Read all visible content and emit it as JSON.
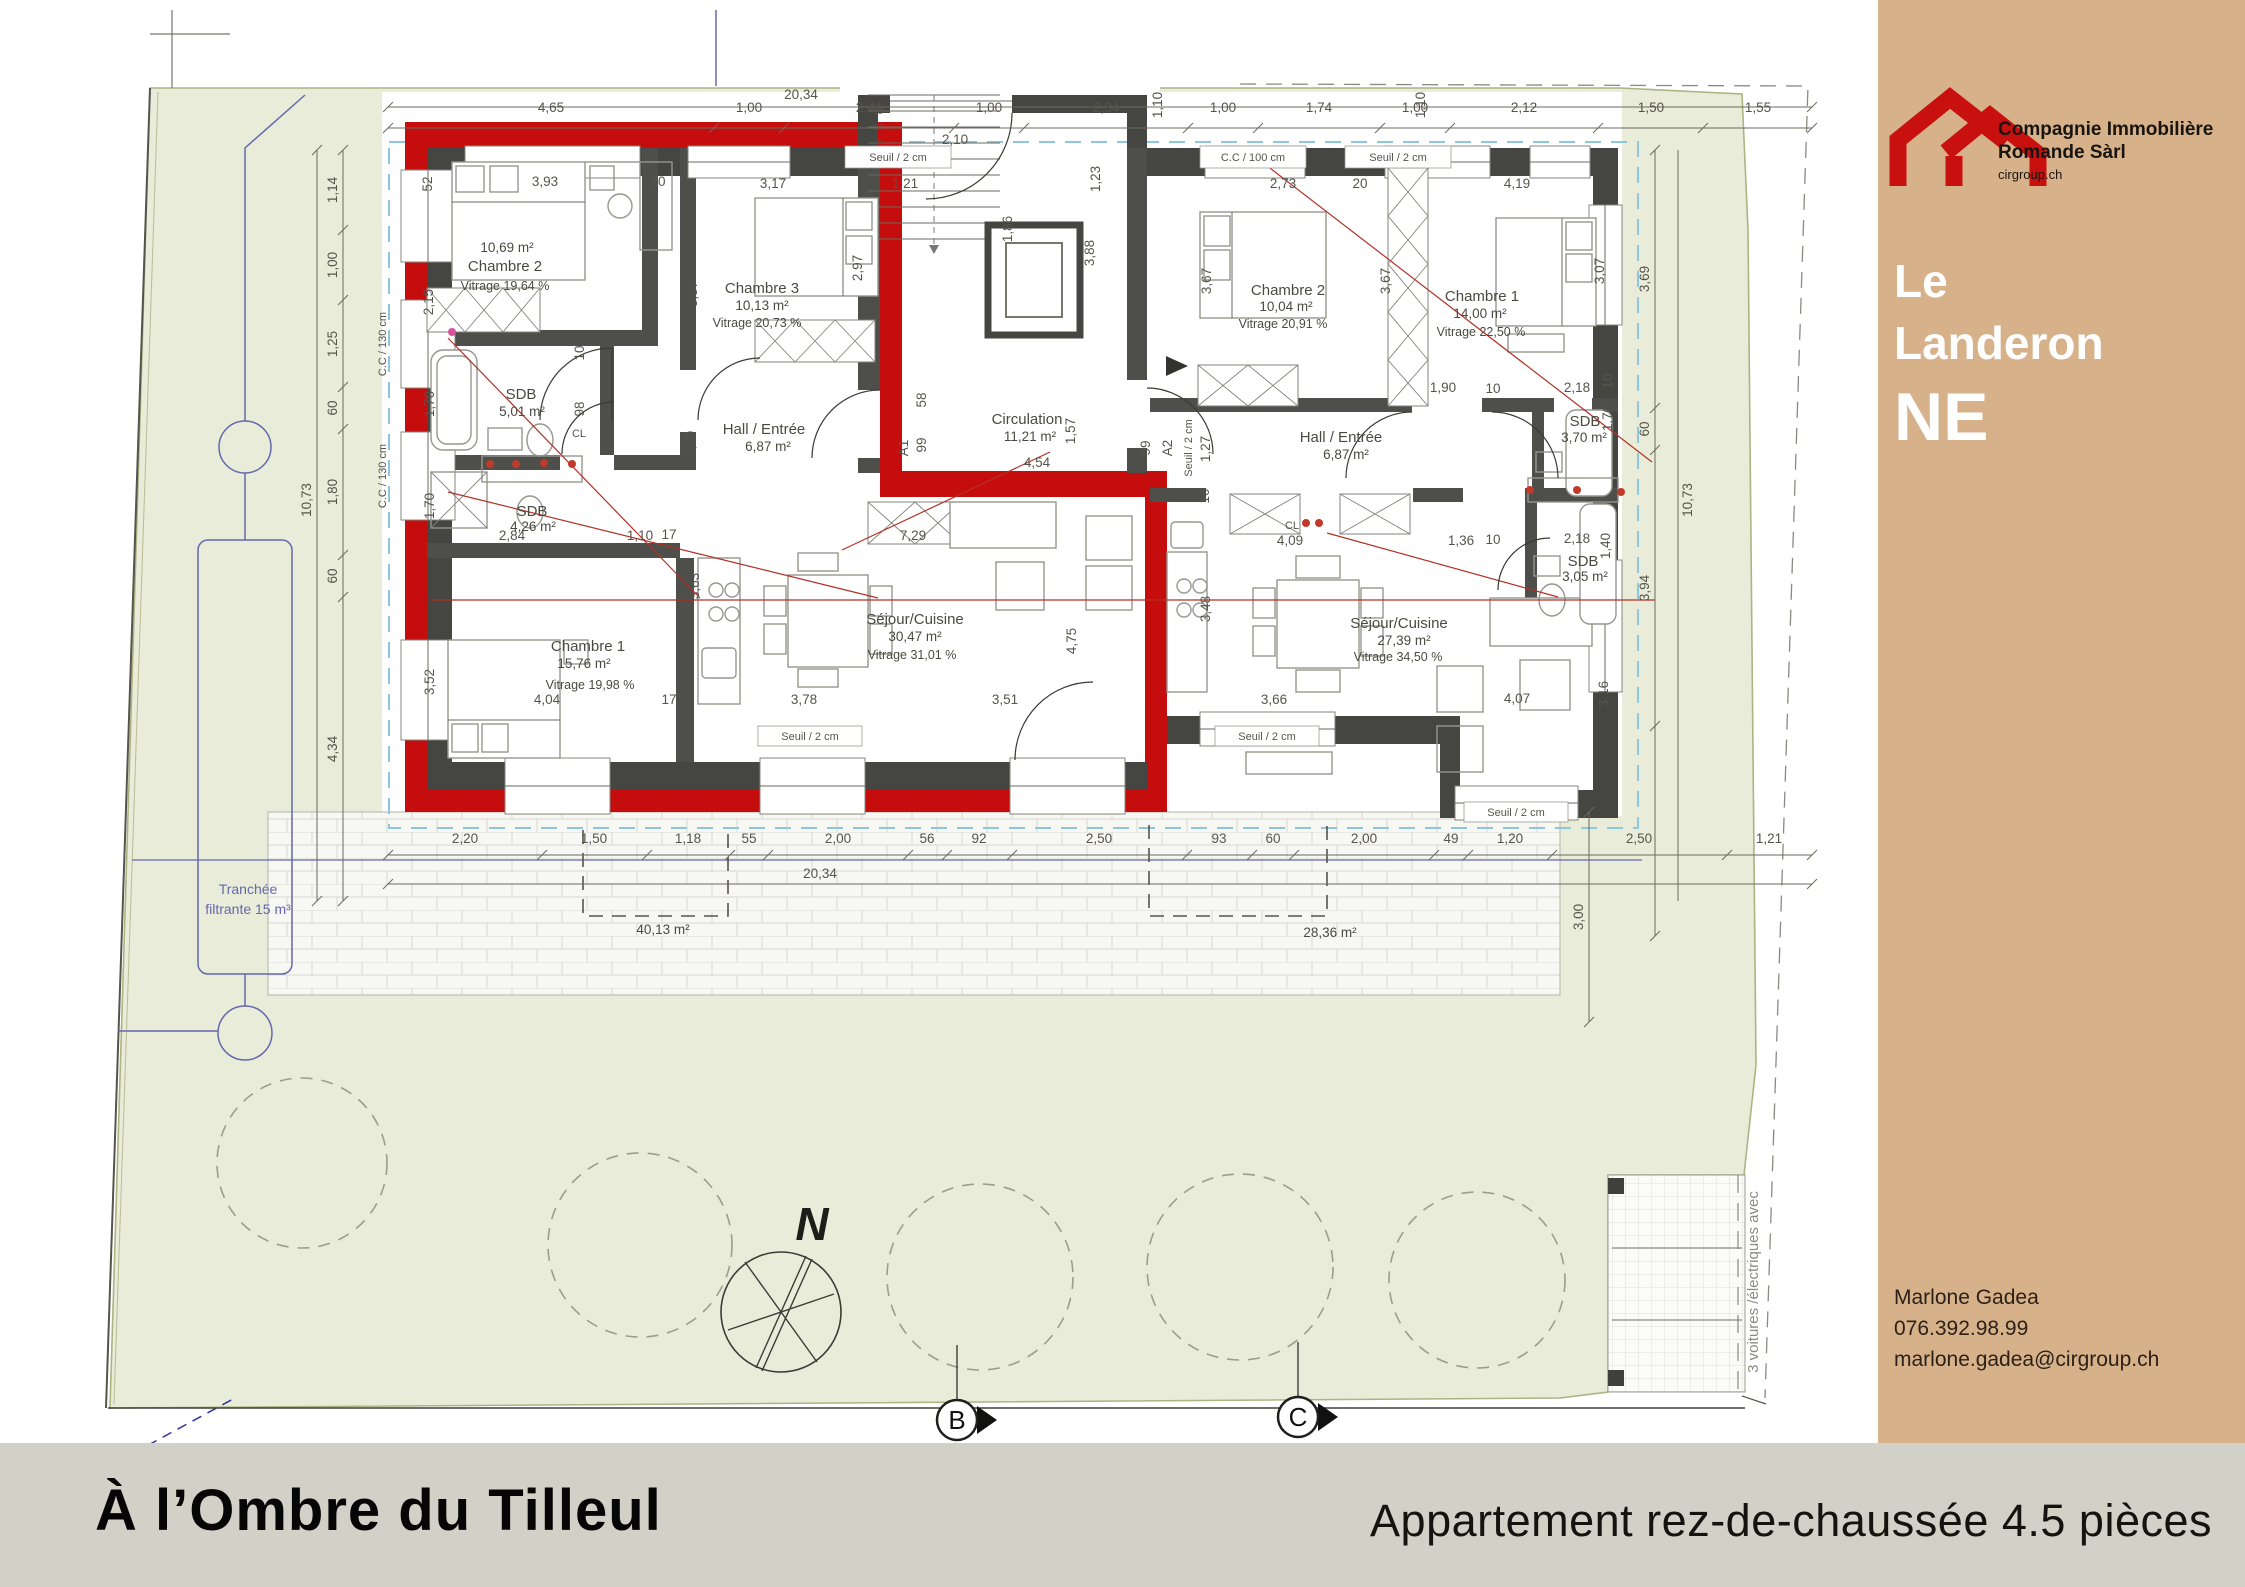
{
  "sidebar": {
    "logo": {
      "company_line1": "Compagnie Immobilière",
      "company_line2": "Romande Sàrl",
      "website": "cirgroup.ch"
    },
    "title": {
      "line1": "Le",
      "line2": "Landeron",
      "canton": "NE"
    },
    "contact": {
      "name": "Marlone Gadea",
      "phone": "076.392.98.99",
      "email": "marlone.gadea@cirgroup.ch"
    }
  },
  "footer": {
    "project_name": "À l’Ombre du Tilleul",
    "apartment_label": "Appartement rez-de-chaussée 4.5 pièces"
  },
  "plan": {
    "rooms": {
      "left_chambre2": {
        "area": "10,69 m²",
        "name": "Chambre 2",
        "vitrage": "Vitrage 19,64 %"
      },
      "left_chambre3": {
        "name": "Chambre 3",
        "area": "10,13 m²",
        "vitrage": "Vitrage 20,73 %"
      },
      "left_sdb1": {
        "name": "SDB",
        "area": "5,01 m²"
      },
      "left_hall": {
        "name": "Hall / Entrée",
        "area": "6,87 m²"
      },
      "left_sdb2": {
        "name": "SDB",
        "area": "4,26 m²"
      },
      "left_chambre1": {
        "name": "Chambre 1",
        "area": "15,76 m²",
        "vitrage": "Vitrage 19,98 %"
      },
      "left_sejour": {
        "name": "Séjour/Cuisine",
        "area": "30,47 m²",
        "vitrage": "Vitrage 31,01 %"
      },
      "circulation": {
        "name": "Circulation",
        "area": "11,21 m²"
      },
      "right_chambre2": {
        "name": "Chambre 2",
        "area": "10,04 m²",
        "vitrage": "Vitrage 20,91 %"
      },
      "right_chambre1": {
        "name": "Chambre 1",
        "area": "14,00 m²",
        "vitrage": "Vitrage 22,50 %"
      },
      "right_hall": {
        "name": "Hall / Entrée",
        "area": "6,87 m²"
      },
      "right_sdb1": {
        "name": "SDB",
        "area": "3,70 m²"
      },
      "right_sdb2": {
        "name": "SDB",
        "area": "3,05 m²"
      },
      "right_sejour": {
        "name": "Séjour/Cuisine",
        "area": "27,39 m²",
        "vitrage": "Vitrage 34,50 %"
      }
    },
    "annotations": {
      "cl": "CL",
      "a1": "A1",
      "a2": "A2",
      "seuil": "Seuil / 2 cm",
      "cc100": "C.C / 100 cm",
      "cc130": "C.C / 130 cm",
      "canopy": "1,10"
    },
    "dims_top": [
      "4,65",
      "1,00",
      "2,44",
      "1,00",
      "2,34",
      "1,00",
      "1,74",
      "1,00",
      "2,12",
      "1,50",
      "1,55"
    ],
    "dims_top_total": "20,34",
    "dims_bottom": [
      "2,20",
      "1,50",
      "1,18",
      "55",
      "2,00",
      "56",
      "92",
      "2,50",
      "93",
      "60",
      "2,00",
      "49",
      "1,20",
      "2,50",
      "1,21"
    ],
    "dims_bottom_total": "20,34",
    "dims_left": [
      "1,14",
      "1,00",
      "1,25",
      "60",
      "1,80",
      "60",
      "4,34"
    ],
    "dims_left_total": "10,73",
    "dims_right": [
      "3,69",
      "60",
      "3,94"
    ],
    "dims_right_total": "10,73",
    "dim_terrace_side": "3,00",
    "dims_inner": [
      "52",
      "3,93",
      "20",
      "3,17",
      "1,21",
      "2,15",
      "3,57",
      "2,97",
      "1,70",
      "98",
      "10",
      "1,70",
      "3,52",
      "2,84",
      "1,10",
      "17",
      "4,04",
      "17",
      "3,78",
      "3,51",
      "7,29",
      "3,63",
      "4,75",
      "4,54",
      "1,57",
      "58",
      "99",
      "99",
      "1,27",
      "3,88",
      "1,86",
      "1,23",
      "2,10",
      "2,73",
      "20",
      "4,19",
      "3,67",
      "3,67",
      "3,07",
      "1,90",
      "10",
      "2,18",
      "1,70",
      "10",
      "4,09",
      "1,36",
      "10",
      "2,18",
      "1,40",
      "3,48",
      "3,66",
      "4,07",
      "3,16",
      "10",
      "1,20"
    ],
    "site": {
      "trench_line1": "Tranchée",
      "trench_line2": "filtrante 15 m³",
      "terrace_left_area": "40,13 m²",
      "terrace_right_area": "28,36 m²",
      "parking_note": "3 voitures /électriques avec",
      "north_label": "N",
      "axis_b": "B",
      "axis_c": "C",
      "stair_numbers": [
        "13",
        "14",
        "15",
        "16"
      ]
    }
  },
  "colors": {
    "accent_red": "#c50d0d",
    "sidebar_tan": "#d7b18a",
    "footer_gray": "#d1d1c7",
    "lawn_green": "#e9ecd9"
  }
}
